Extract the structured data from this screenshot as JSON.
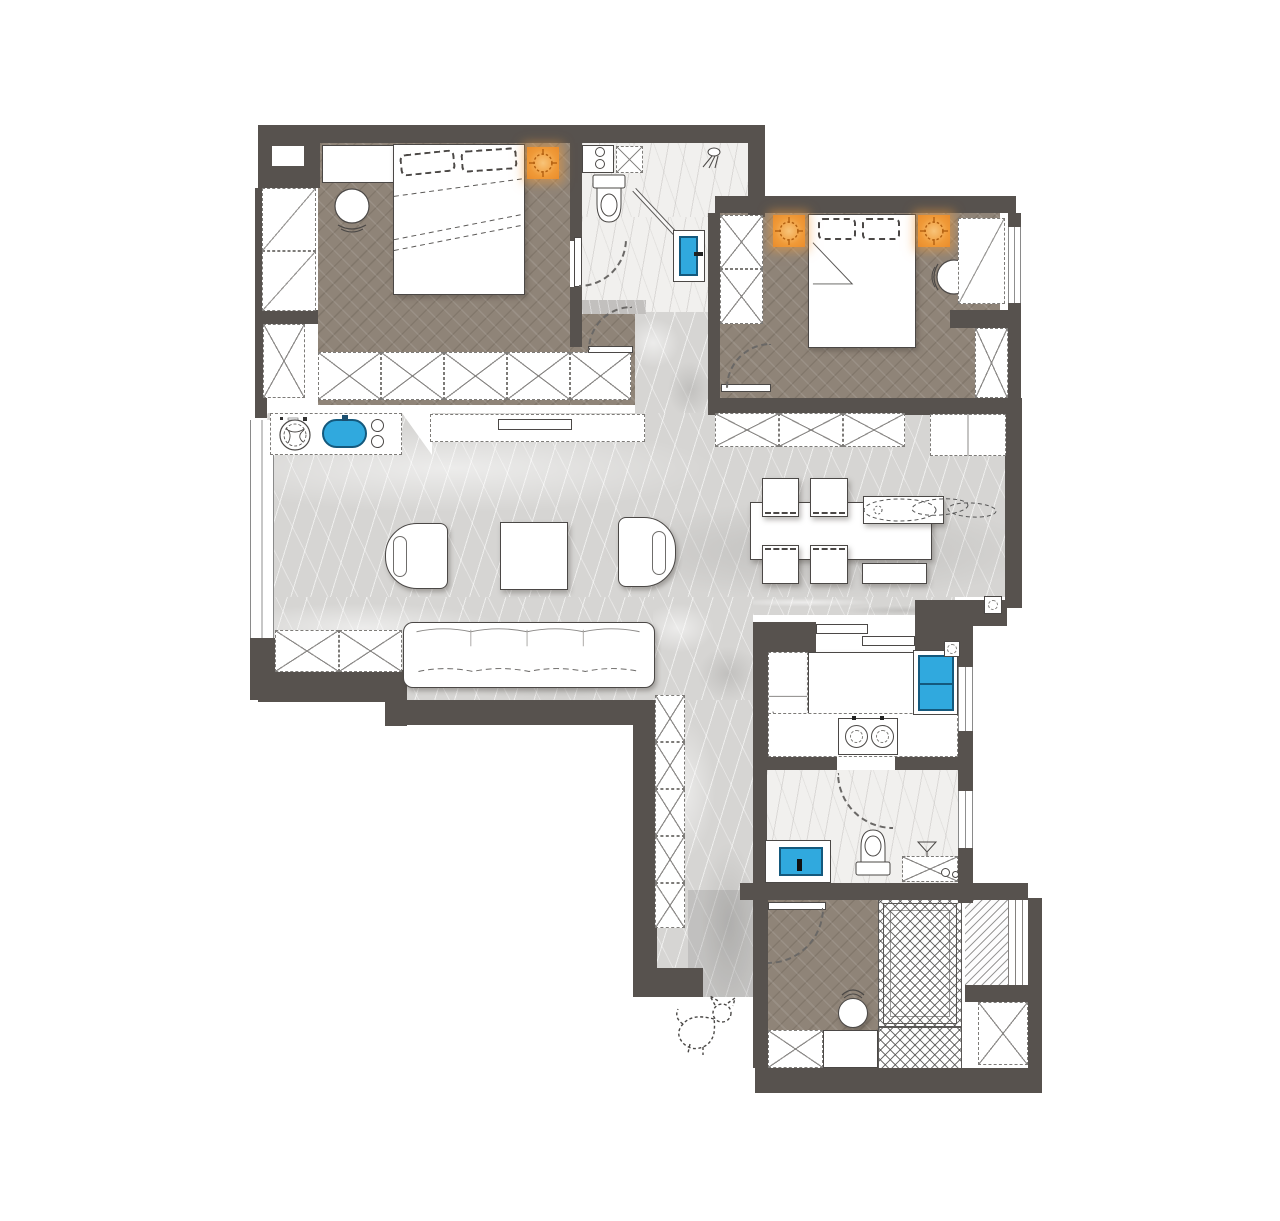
{
  "document": {
    "title": "Apartment floor plan rendering",
    "type": "interior-design-plan",
    "text_labels_visible": false
  },
  "palette": {
    "background": "#ffffff",
    "wall": "#57524e",
    "wood_floor": "#8f8478",
    "stone_floor": "#d6d5d3",
    "stone_floor_light": "#f1f0ee",
    "accent_orange": "#f0953a",
    "accent_blue": "#30a9de",
    "furniture_line": "#4b4846",
    "cabinet_dash": "#7d7b78"
  },
  "rooms": [
    {
      "id": "bedroom-primary",
      "floor": "wood-herringbone",
      "items": [
        "double-bed",
        "two-pillows",
        "bedside-table",
        "round-stool",
        "side-closets",
        "wardrobe-run",
        "ceiling-light",
        "swing-door"
      ]
    },
    {
      "id": "bathroom-ensuite",
      "floor": "stone-light",
      "items": [
        "toilet",
        "service-shaft",
        "vanity-counter",
        "glass-screen",
        "shower-head",
        "wash-basin-blue",
        "swing-door"
      ]
    },
    {
      "id": "bedroom-second",
      "floor": "wood-herringbone",
      "items": [
        "double-bed",
        "two-pillows",
        "round-stool",
        "wardrobe",
        "desk",
        "closet",
        "two-ceiling-lights",
        "swing-door",
        "window"
      ]
    },
    {
      "id": "living-dining",
      "floor": "stone-marble",
      "items": [
        "sofa",
        "coffee-table",
        "armchair-left",
        "armchair-right",
        "laundry-counter",
        "washing-machine",
        "utility-sink-blue",
        "long-counter",
        "dining-table",
        "four-chairs",
        "island-console",
        "bench",
        "plant-sketch",
        "sideboard-row",
        "tall-cabinet",
        "low-cabinet",
        "window"
      ]
    },
    {
      "id": "kitchen",
      "floor": "stone-light",
      "items": [
        "island-counter",
        "double-sink-blue",
        "cooktop-two-burners",
        "tall-units",
        "sliding-door",
        "window",
        "floor-drain"
      ]
    },
    {
      "id": "bathroom-second",
      "floor": "stone-light",
      "items": [
        "toilet",
        "shower-area",
        "floor-drain-grid",
        "vanity-basin-blue",
        "swing-door",
        "window"
      ]
    },
    {
      "id": "hallway",
      "floor": "stone-marble",
      "items": [
        "storage-column"
      ]
    },
    {
      "id": "utility-room",
      "floor": "wood-herringbone",
      "items": [
        "round-table",
        "chair",
        "sliding-door",
        "storage-cabinet"
      ]
    },
    {
      "id": "balcony-deck",
      "floor": "tile-crosshatch",
      "items": [
        "deck-border",
        "louver-strip",
        "storage-closet"
      ]
    }
  ],
  "symbols": {
    "ceiling_lights": 3,
    "doors": 6,
    "windows": 5,
    "floor_drains": 2,
    "pet_sketch": "dog-doodle"
  }
}
